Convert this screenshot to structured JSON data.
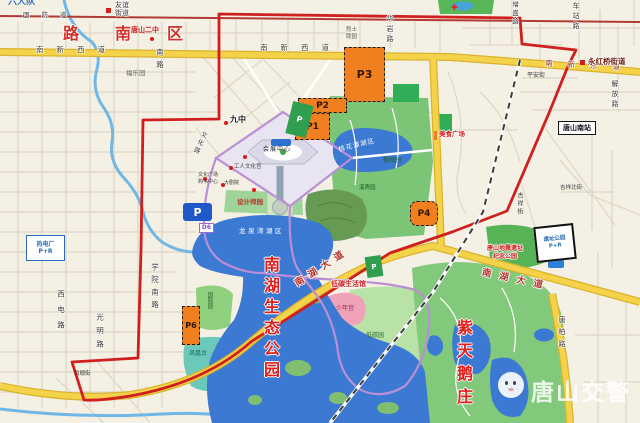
{
  "region": {
    "district": "路南区",
    "brigade": "六大队",
    "watermark": "唐山交警"
  },
  "roads": {
    "guofangdao": "国防道",
    "nanxinxidao": "南新西道",
    "nanxindongdao": "南新东道",
    "huayanlu": "华岩路",
    "chezhanlu": "车站路",
    "zengshenglu": "增盛路",
    "jiefanglu": "解放路",
    "pinganjie": "平安街",
    "jixiangbeijie": "吉祥北街",
    "jixiangjie": "吉祥街",
    "tangbailu": "唐柏路",
    "xueyuannanlu": "学院南路",
    "nanlu": "南路",
    "guangminglu": "光明路",
    "xidianlu": "西电路",
    "wenhualu": "文化路",
    "heshunjie": "和顺街",
    "nanhudadao": "南湖大道"
  },
  "subdistricts": {
    "youyijiedao": "友谊街道",
    "yonghongqiaojiedao": "永红桥街道"
  },
  "pois": {
    "tangshanerzhong": "唐山二中",
    "jiuzhong": "九中",
    "fuleyuan": "福乐园",
    "lieshilingyuan": "烈士陵园",
    "gongrenwenhuagong": "工人文化宫",
    "wenhuaguangchang": "文化广场",
    "goushuzhongxin": "购书中心",
    "dajuyuan": "大剧院",
    "huizhanzhongxin": "会展中心",
    "meishiguangchang": "美食广场",
    "ditanshenghuoguan": "低碳生活馆",
    "tangshannanzhan": "唐山南站",
    "dizhenyizhi_line1": "唐山地震遗址",
    "dizhenyizhi_line2": "纪念公园"
  },
  "parks": {
    "nanhushengtaigongyuan": "南湖生态公园",
    "zitianezhuang": "紫天鹅庄",
    "longquanwanhuqu": "龙泉湾湖区",
    "taohuatanhuqu": "桃花潭湖区",
    "zhiwuyuan": "植物园",
    "xixiuyuan": "溪秀园",
    "guojiyuan": "国际园",
    "fenghuangtai": "凤凰台",
    "shaoniangong": "少年宫",
    "ditanyuan": "低碳园",
    "shejishiyuan": "设计师园"
  },
  "parking": {
    "p1": "P1",
    "p2": "P2",
    "p3": "P3",
    "p4": "P4",
    "p6": "P6",
    "p_blue": "P",
    "p_green": "P",
    "redianchang": "热电厂",
    "redianchang_pr": "P+R",
    "yizhigongyuan": "遗址公园",
    "yizhigongyuan_pr": "P+R",
    "d6": "D6"
  },
  "colors": {
    "boundary_red": "#d01f1f",
    "road_yellow": "#f4d34a",
    "water_blue": "#3c79d2",
    "park_green": "#83c97b",
    "parking_orange": "#f07f1f",
    "parking_blue": "#1f58c9",
    "route_purple": "#b98fd6"
  }
}
